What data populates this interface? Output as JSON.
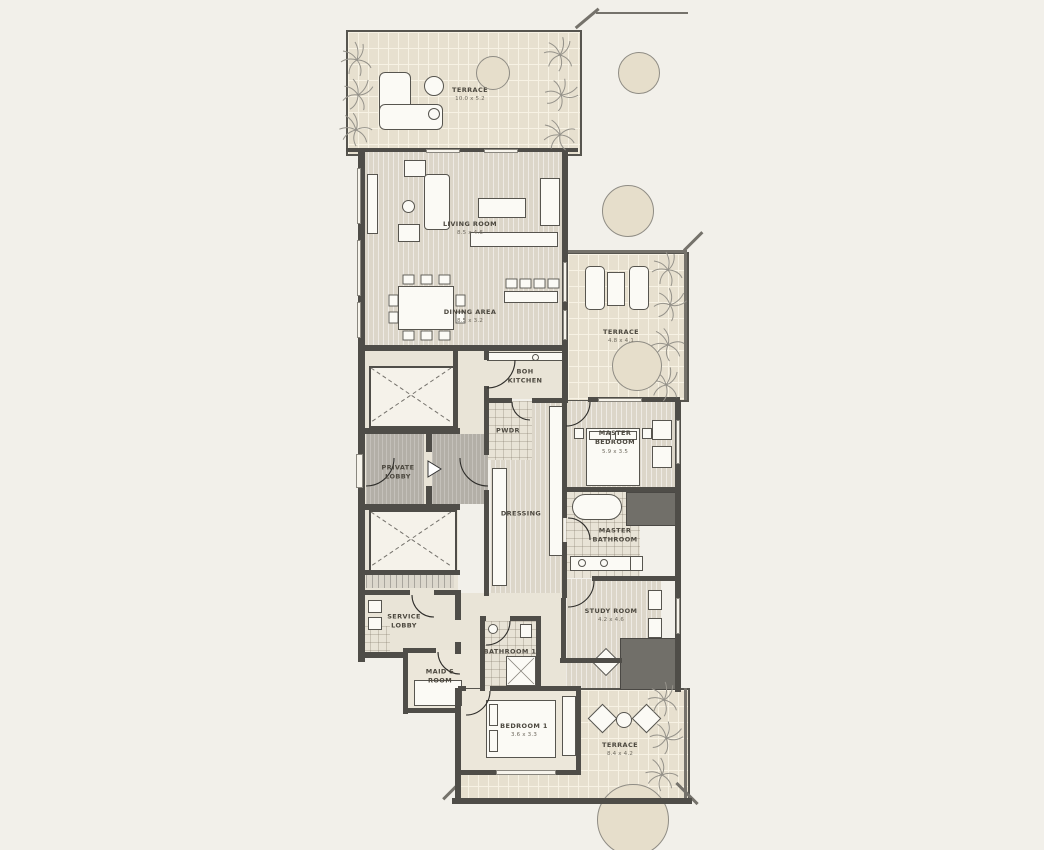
{
  "rooms": [
    {
      "name": "terrace-top",
      "label": "TERRACE",
      "dim": "10.0 x 5.2"
    },
    {
      "name": "living-room",
      "label": "LIVING ROOM",
      "dim": "8.5 x 4.6"
    },
    {
      "name": "dining-area",
      "label": "DINING AREA",
      "dim": "8.5 x 3.2"
    },
    {
      "name": "terrace-right",
      "label": "TERRACE",
      "dim": "4.8 x 4.1"
    },
    {
      "name": "boh-kitchen",
      "label": "BOH KITCHEN",
      "dim": ""
    },
    {
      "name": "pwdr",
      "label": "PWDR",
      "dim": ""
    },
    {
      "name": "private-lobby",
      "label": "PRIVATE LOBBY",
      "dim": ""
    },
    {
      "name": "master-bedroom",
      "label": "MASTER BEDROOM",
      "dim": "5.9 x 3.5"
    },
    {
      "name": "dressing",
      "label": "DRESSING",
      "dim": ""
    },
    {
      "name": "master-bathroom",
      "label": "MASTER BATHROOM",
      "dim": ""
    },
    {
      "name": "study-room",
      "label": "STUDY ROOM",
      "dim": "4.2 x 4.6"
    },
    {
      "name": "service-lobby",
      "label": "SERVICE LOBBY",
      "dim": ""
    },
    {
      "name": "maids-room",
      "label": "MAID'S ROOM",
      "dim": ""
    },
    {
      "name": "bathroom-1",
      "label": "BATHROOM 1",
      "dim": ""
    },
    {
      "name": "bedroom-1",
      "label": "BEDROOM 1",
      "dim": "3.6 x 3.3"
    },
    {
      "name": "terrace-bottom",
      "label": "TERRACE",
      "dim": "8.4 x 4.2"
    }
  ],
  "colors": {
    "background": "#f2f0ea",
    "wall": "#4f4d48",
    "brick_floor": "#e7e0cf",
    "plank_floor": "#dcd6c9",
    "tile_floor": "#e8e3d6",
    "lobby_floor": "#b3afa7",
    "tree_fill": "#e6decb",
    "furniture": "#fbfaf5",
    "dark_block": "#716f69"
  }
}
